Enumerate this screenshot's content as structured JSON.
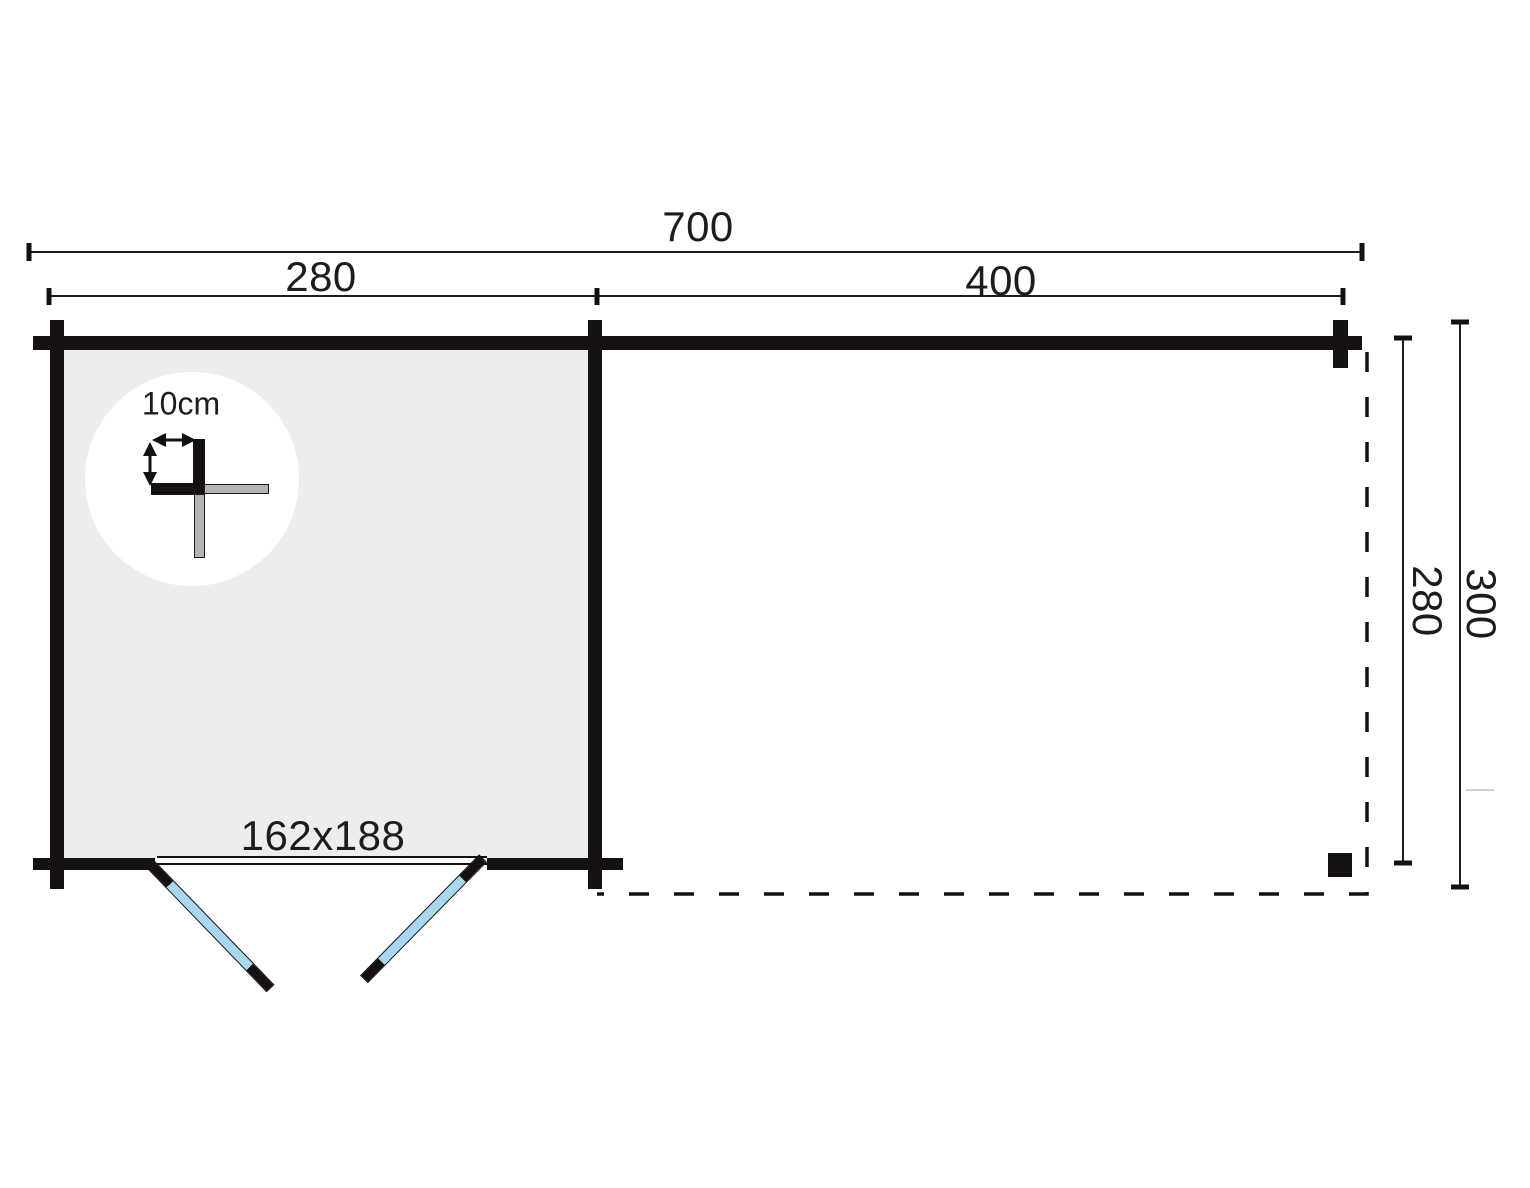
{
  "plan": {
    "width_total_label": "700",
    "width_cabin_label": "280",
    "width_canopy_label": "400",
    "depth_inner_label": "280",
    "depth_total_label": "300",
    "door_size_label": "162x188",
    "wall_thickness_label": "10cm"
  },
  "colors": {
    "wall": "#141110",
    "room_fill": "#ededed",
    "door_glass": "#a8d7f2",
    "detail_gray": "#b3b3b3",
    "ink": "#1c1c1c"
  }
}
